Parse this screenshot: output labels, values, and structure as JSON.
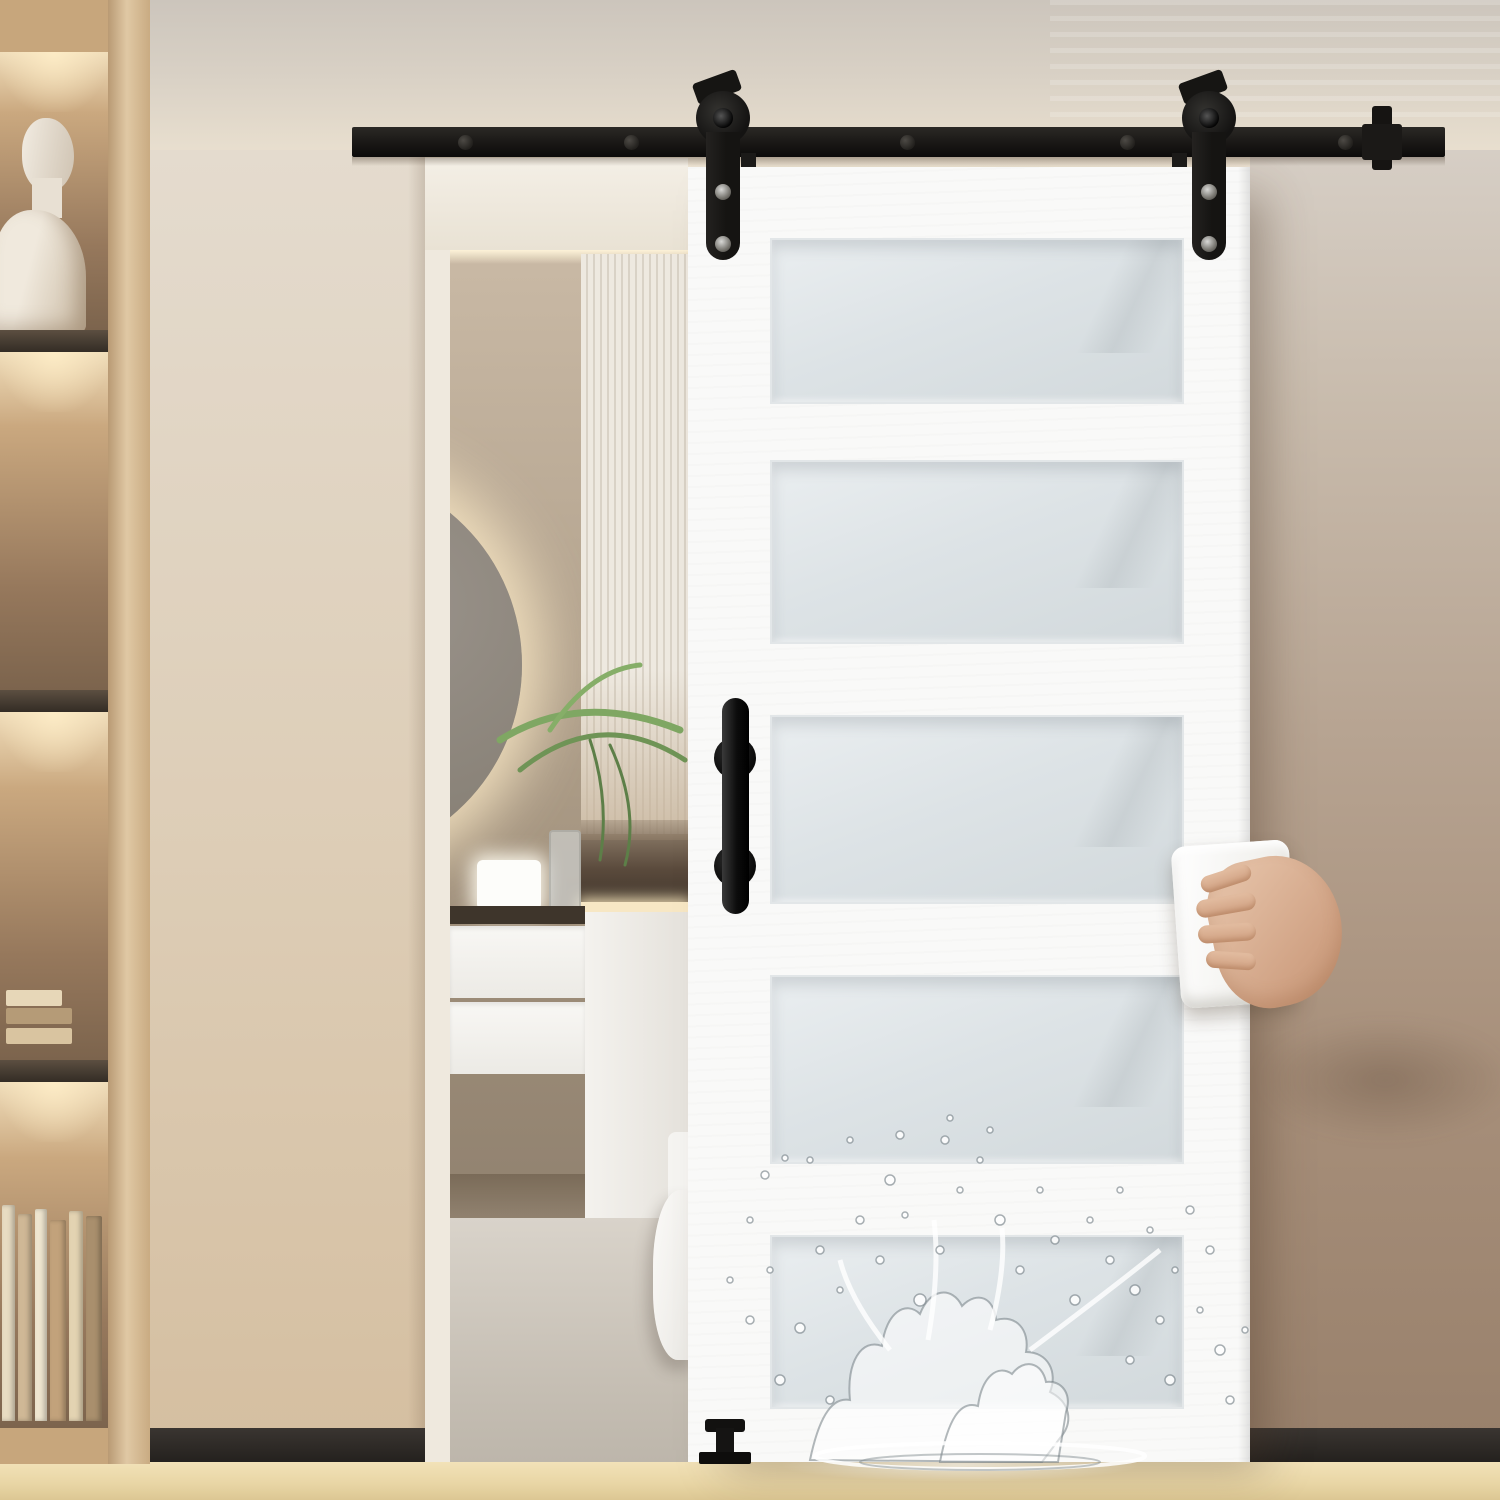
{
  "features": [
    {
      "label": "Widely Use",
      "icon": "network-nodes-icon"
    },
    {
      "label": "Easy Install",
      "icon": "drill-icon"
    },
    {
      "label": "Easy to clean",
      "icon": "hand-wipe-icon"
    },
    {
      "label": "Waterproof",
      "icon": "waterproof-drops-icon"
    }
  ],
  "colors": {
    "badge_ring": "#ecca9e",
    "badge_fill": "#ececeb",
    "label_text": "#ffffff",
    "hardware_black": "#171513",
    "door_white": "#f9f9f8",
    "frosted_glass": "#dde3e6",
    "left_wall": "#ddd0bd",
    "right_wall": "#a78f7a",
    "wood_floor": "#e9d6a6"
  }
}
